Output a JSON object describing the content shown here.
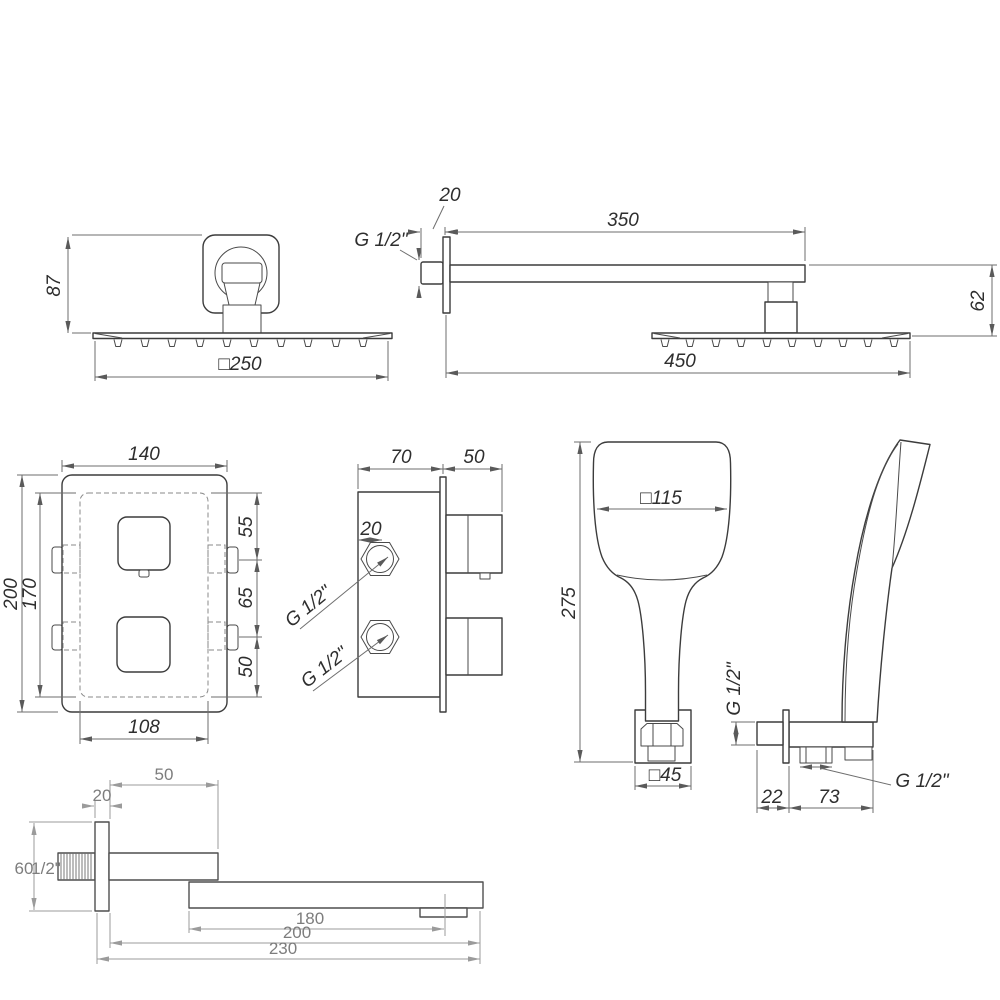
{
  "palette": {
    "background": "#ffffff",
    "object_line": "#3c3c3c",
    "dimension_line": "#6e6e6e",
    "dimension_text": "#2e2e2e",
    "light_dimension_line": "#9b9b9b",
    "light_dimension_text": "#7d7d7d"
  },
  "views": {
    "rain_shower_head_front": {
      "height": "87",
      "width": "□250"
    },
    "shower_arm_side": {
      "wall_plate": "20",
      "arm_length": "350",
      "thread": "G 1/2\"",
      "head_drop": "62",
      "overall_length": "450"
    },
    "mixer_front": {
      "width": "140",
      "height": "200",
      "inner_height": "170",
      "seg_top": "55",
      "seg_mid": "65",
      "seg_bottom": "50",
      "inner_width": "108"
    },
    "mixer_side": {
      "body_depth": "70",
      "knob_depth": "50",
      "fitting": "20",
      "inlet_upper": "G 1/2\"",
      "inlet_lower": "G 1/2\""
    },
    "hand_shower_front": {
      "head_width": "□115",
      "height": "275",
      "base_width": "□45"
    },
    "hand_shower_side": {
      "inlet_thread": "G 1/2\"",
      "offset": "22",
      "arm_length": "73",
      "outlet_thread": "G 1/2\""
    },
    "spout_side": {
      "upper_arm": "50",
      "wall_plate": "20",
      "height": "60",
      "thread": "1/2\"",
      "outlet_offset": "180",
      "body_length": "200",
      "overall_length": "230"
    }
  }
}
